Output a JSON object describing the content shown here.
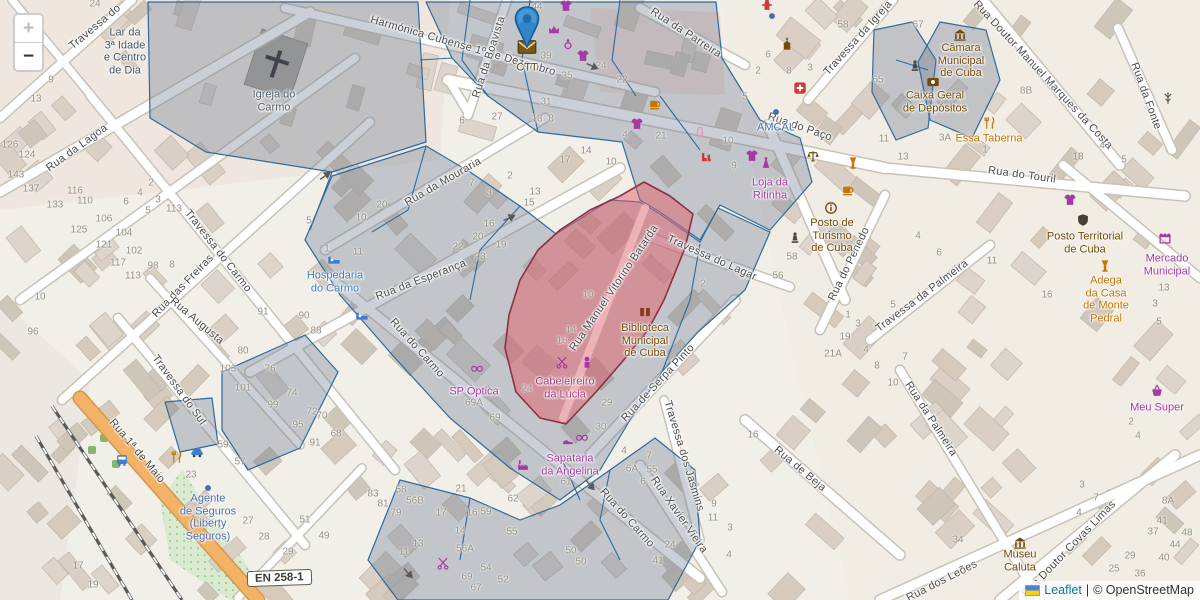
{
  "map": {
    "controls": {
      "zoom_in": "+",
      "zoom_out": "−"
    },
    "attribution": {
      "leaflet": "Leaflet",
      "separator": "|",
      "osm": "© OpenStreetMap"
    },
    "road_shield": "EN 258-1",
    "marker": {
      "poi": "CTT"
    },
    "colors": {
      "shop": "#a539a5",
      "food": "#c77400",
      "civic": "#734a08",
      "tourism": "#3d7cc9",
      "office": "#4a6cae",
      "health": "#cc3b3b",
      "worship": "#51606b",
      "social": "#445668",
      "hair_in_zone": "#ad3a78",
      "street": "#4c4c4c",
      "marker_blue": "#2f86cb",
      "overlay_blue_stroke": "#2f6a9e",
      "red_zone_fill": "#e05f6b",
      "red_zone_stroke": "#8f2f45"
    },
    "street_labels": [
      {
        "t": "Travessa do",
        "x": 95,
        "y": 27,
        "r": -40
      },
      {
        "t": "Harmónica Cubense 1º de Dezembro",
        "x": 463,
        "y": 46,
        "r": 16
      },
      {
        "t": "Rua da Boavista",
        "x": 489,
        "y": 57,
        "r": -72
      },
      {
        "t": "Rua da Parreira",
        "x": 686,
        "y": 33,
        "r": 33
      },
      {
        "t": "Travessa da Igreja",
        "x": 858,
        "y": 38,
        "r": -48
      },
      {
        "t": "Rua Doutor Manuel Marques da Costa",
        "x": 1043,
        "y": 75,
        "r": 47
      },
      {
        "t": "Rua da Fonte",
        "x": 1146,
        "y": 96,
        "r": 70
      },
      {
        "t": "Rua do Paço",
        "x": 800,
        "y": 127,
        "r": 19
      },
      {
        "t": "Rua do Touril",
        "x": 1022,
        "y": 175,
        "r": 8
      },
      {
        "t": "Rua da Mouraria",
        "x": 443,
        "y": 182,
        "r": -30
      },
      {
        "t": "Rua da Lagoa",
        "x": 77,
        "y": 148,
        "r": -36
      },
      {
        "t": "Travessa do Carmo",
        "x": 218,
        "y": 251,
        "r": 52
      },
      {
        "t": "Rua das Freiras",
        "x": 183,
        "y": 286,
        "r": -46
      },
      {
        "t": "Rua Augusta",
        "x": 197,
        "y": 321,
        "r": 40
      },
      {
        "t": "Rua da Esperança",
        "x": 421,
        "y": 280,
        "r": -21
      },
      {
        "t": "Travessa do Sul",
        "x": 179,
        "y": 390,
        "r": 54
      },
      {
        "t": "Rua 1ª de Maio",
        "x": 137,
        "y": 451,
        "r": 50
      },
      {
        "t": "Rua do Carmo",
        "x": 417,
        "y": 348,
        "r": 48
      },
      {
        "t": "Rua do Carmo",
        "x": 627,
        "y": 518,
        "r": 48
      },
      {
        "t": "Rua Manuel Vitorino Batarda",
        "x": 614,
        "y": 288,
        "r": -56
      },
      {
        "t": "Travessa do Lagar",
        "x": 712,
        "y": 258,
        "r": 24
      },
      {
        "t": "Rua de Serpa Pinto",
        "x": 658,
        "y": 383,
        "r": -47
      },
      {
        "t": "Travessa dos Jasmins",
        "x": 684,
        "y": 456,
        "r": 73
      },
      {
        "t": "Rua Xavier Vieira",
        "x": 679,
        "y": 515,
        "r": 55
      },
      {
        "t": "Rua do Penedo",
        "x": 849,
        "y": 264,
        "r": -64
      },
      {
        "t": "Travessa da Palmeira",
        "x": 922,
        "y": 296,
        "r": -37
      },
      {
        "t": "Rua da Palmeira",
        "x": 931,
        "y": 419,
        "r": 57
      },
      {
        "t": "Rua de Beja",
        "x": 800,
        "y": 469,
        "r": 40
      },
      {
        "t": "Rua Doutor Covas Limas",
        "x": 1069,
        "y": 549,
        "r": -46
      },
      {
        "t": "Rua dos Leões",
        "x": 942,
        "y": 581,
        "r": -27
      }
    ],
    "poi_labels": [
      {
        "t": "Igreja do\nCarmo",
        "x": 274,
        "y": 101,
        "c": "worship"
      },
      {
        "t": "Lar da\n3ª Idade\ne Centro\nde Dia",
        "x": 125,
        "y": 52,
        "c": "social"
      },
      {
        "t": "CTT",
        "x": 527,
        "y": 68,
        "c": "civic"
      },
      {
        "t": "Hospedaria\ndo Carmo",
        "x": 335,
        "y": 282,
        "c": "tourism"
      },
      {
        "t": "AMCAL",
        "x": 776,
        "y": 128,
        "c": "office"
      },
      {
        "t": "Loja da\nRitinha",
        "x": 770,
        "y": 189,
        "c": "shop"
      },
      {
        "t": "Posto de\nTurismo\nde Cuba",
        "x": 832,
        "y": 236,
        "c": "civic"
      },
      {
        "t": "Câmara\nMunicipal\nde Cuba",
        "x": 961,
        "y": 61,
        "c": "civic"
      },
      {
        "t": "Caixa Geral\nde Depósitos",
        "x": 935,
        "y": 102,
        "c": "civic"
      },
      {
        "t": "Essa Taberna",
        "x": 989,
        "y": 139,
        "c": "food"
      },
      {
        "t": "Posto Territorial\nde Cuba",
        "x": 1085,
        "y": 243,
        "c": "civic"
      },
      {
        "t": "Mercado\nMunicipal",
        "x": 1167,
        "y": 265,
        "c": "shop"
      },
      {
        "t": "Adega\nda Casa\nde Monte\nPedral",
        "x": 1106,
        "y": 300,
        "c": "food"
      },
      {
        "t": "Biblioteca\nMunicipal\nde Cuba",
        "x": 645,
        "y": 341,
        "c": "civic"
      },
      {
        "t": "SP Óptica",
        "x": 474,
        "y": 392,
        "c": "shop"
      },
      {
        "t": "Cabeleireiro\nda Lúcia",
        "x": 565,
        "y": 388,
        "c": "hair_in_zone"
      },
      {
        "t": "Sapataria\nda Angelina",
        "x": 570,
        "y": 465,
        "c": "shop"
      },
      {
        "t": "Agente\nde Seguros\n(Liberty\nSeguros)",
        "x": 208,
        "y": 518,
        "c": "office"
      },
      {
        "t": "Meu Super",
        "x": 1157,
        "y": 408,
        "c": "shop"
      },
      {
        "t": "Museu\nCaluta",
        "x": 1020,
        "y": 561,
        "c": "civic"
      }
    ],
    "icons": [
      [
        "envelope",
        527,
        47
      ],
      [
        "tshirt",
        566,
        6
      ],
      [
        "crown",
        554,
        30
      ],
      [
        "ring",
        568,
        44
      ],
      [
        "tshirt",
        583,
        56
      ],
      [
        "cup",
        655,
        104
      ],
      [
        "tshirt",
        637,
        124
      ],
      [
        "clip",
        700,
        132
      ],
      [
        "boots",
        706,
        158
      ],
      [
        "tshirt",
        752,
        156
      ],
      [
        "dress",
        766,
        163
      ],
      [
        "scales",
        813,
        156
      ],
      [
        "pharmacy",
        800,
        88
      ],
      [
        "hydrant",
        767,
        5
      ],
      [
        "chapel",
        787,
        44
      ],
      [
        "dot",
        772,
        16
      ],
      [
        "dot",
        776,
        112
      ],
      [
        "statue",
        915,
        66
      ],
      [
        "cup",
        848,
        190
      ],
      [
        "goblet",
        853,
        163
      ],
      [
        "statue",
        795,
        238
      ],
      [
        "mast",
        1168,
        98
      ],
      [
        "info",
        831,
        208
      ],
      [
        "townhall",
        960,
        35
      ],
      [
        "bank",
        933,
        82
      ],
      [
        "cutlery",
        990,
        123
      ],
      [
        "police",
        1083,
        220
      ],
      [
        "tshirt",
        1070,
        200
      ],
      [
        "market",
        1165,
        238
      ],
      [
        "wine",
        1105,
        266
      ],
      [
        "basket",
        1157,
        391
      ],
      [
        "museum",
        1020,
        543
      ],
      [
        "bed",
        334,
        260
      ],
      [
        "bed",
        362,
        316
      ],
      [
        "book",
        645,
        312
      ],
      [
        "glasses",
        477,
        368
      ],
      [
        "scissors",
        562,
        362
      ],
      [
        "cosmetics",
        587,
        362
      ],
      [
        "shoe",
        568,
        440
      ],
      [
        "glasses",
        582,
        437
      ],
      [
        "factory",
        523,
        465
      ],
      [
        "scissors",
        443,
        563
      ],
      [
        "bus",
        122,
        460
      ],
      [
        "car",
        197,
        452
      ],
      [
        "cutlery",
        177,
        457
      ],
      [
        "dot",
        208,
        488
      ]
    ],
    "house_numbers": [
      [
        "24",
        95,
        4
      ],
      [
        "9",
        51,
        80
      ],
      [
        "13",
        36,
        99
      ],
      [
        "126",
        10,
        145
      ],
      [
        "124",
        27,
        155
      ],
      [
        "143",
        16,
        175
      ],
      [
        "137",
        31,
        189
      ],
      [
        "133",
        55,
        205
      ],
      [
        "116",
        75,
        191
      ],
      [
        "110",
        85,
        201
      ],
      [
        "106",
        104,
        219
      ],
      [
        "104",
        124,
        233
      ],
      [
        "102",
        134,
        251
      ],
      [
        "125",
        79,
        230
      ],
      [
        "121",
        104,
        245
      ],
      [
        "117",
        118,
        263
      ],
      [
        "113",
        133,
        276
      ],
      [
        "98",
        153,
        266
      ],
      [
        "8",
        172,
        265
      ],
      [
        "5",
        148,
        211
      ],
      [
        "6",
        126,
        202
      ],
      [
        "4",
        140,
        193
      ],
      [
        "3",
        158,
        200
      ],
      [
        "113",
        174,
        209
      ],
      [
        "2",
        151,
        183
      ],
      [
        "96",
        33,
        332
      ],
      [
        "10",
        40,
        297
      ],
      [
        "91",
        263,
        312
      ],
      [
        "90",
        304,
        316
      ],
      [
        "88",
        316,
        331
      ],
      [
        "80",
        243,
        351
      ],
      [
        "76",
        270,
        369
      ],
      [
        "103",
        228,
        369
      ],
      [
        "101",
        243,
        388
      ],
      [
        "74",
        292,
        393
      ],
      [
        "99",
        273,
        405
      ],
      [
        "72",
        312,
        412
      ],
      [
        "70",
        322,
        416
      ],
      [
        "95",
        298,
        425
      ],
      [
        "68",
        336,
        434
      ],
      [
        "17",
        78,
        566
      ],
      [
        "19",
        93,
        585
      ],
      [
        "59",
        223,
        445
      ],
      [
        "57",
        240,
        462
      ],
      [
        "23",
        191,
        475
      ],
      [
        "91",
        315,
        443
      ],
      [
        "27",
        248,
        521
      ],
      [
        "28",
        264,
        537
      ],
      [
        "29",
        288,
        552
      ],
      [
        "51",
        305,
        520
      ],
      [
        "49",
        324,
        536
      ],
      [
        "44",
        537,
        7
      ],
      [
        "39",
        546,
        56
      ],
      [
        "35",
        567,
        76
      ],
      [
        "24",
        601,
        66
      ],
      [
        "22",
        622,
        80
      ],
      [
        "27",
        497,
        117
      ],
      [
        "18",
        537,
        119
      ],
      [
        "8",
        551,
        119
      ],
      [
        "6",
        462,
        121
      ],
      [
        "31",
        546,
        102
      ],
      [
        "20",
        382,
        205
      ],
      [
        "10",
        361,
        218
      ],
      [
        "5",
        309,
        221
      ],
      [
        "11",
        358,
        252
      ],
      [
        "1",
        327,
        249
      ],
      [
        "7",
        472,
        183
      ],
      [
        "2",
        510,
        176
      ],
      [
        "3",
        489,
        193
      ],
      [
        "13",
        535,
        192
      ],
      [
        "15",
        529,
        203
      ],
      [
        "16",
        489,
        224
      ],
      [
        "20",
        478,
        237
      ],
      [
        "22",
        458,
        247
      ],
      [
        "23",
        480,
        257
      ],
      [
        "19",
        501,
        245
      ],
      [
        "17",
        565,
        160
      ],
      [
        "4",
        625,
        135
      ],
      [
        "21",
        661,
        136
      ],
      [
        "14",
        586,
        151
      ],
      [
        "10",
        611,
        162
      ],
      [
        "58",
        843,
        25
      ],
      [
        "67",
        918,
        25
      ],
      [
        "65",
        878,
        80
      ],
      [
        "6",
        768,
        55
      ],
      [
        "8",
        789,
        71
      ],
      [
        "3",
        810,
        68
      ],
      [
        "5",
        745,
        97
      ],
      [
        "2",
        758,
        71
      ],
      [
        "10",
        728,
        141
      ],
      [
        "9",
        734,
        166
      ],
      [
        "11",
        884,
        139
      ],
      [
        "3A",
        945,
        138
      ],
      [
        "13",
        903,
        157
      ],
      [
        "8B",
        1026,
        91
      ],
      [
        "18",
        1078,
        157
      ],
      [
        "4",
        1102,
        146
      ],
      [
        "5",
        1124,
        160
      ],
      [
        "1",
        985,
        150
      ],
      [
        "58",
        792,
        257
      ],
      [
        "56",
        778,
        276
      ],
      [
        "2",
        703,
        284
      ],
      [
        "10",
        588,
        295
      ],
      [
        "14",
        571,
        330
      ],
      [
        "16",
        562,
        341
      ],
      [
        "24",
        527,
        389
      ],
      [
        "29",
        607,
        403
      ],
      [
        "69A",
        474,
        403
      ],
      [
        "69",
        495,
        418
      ],
      [
        "4",
        918,
        236
      ],
      [
        "6",
        939,
        253
      ],
      [
        "11",
        992,
        261
      ],
      [
        "5",
        893,
        305
      ],
      [
        "1",
        848,
        315
      ],
      [
        "3",
        858,
        324
      ],
      [
        "19",
        845,
        337
      ],
      [
        "4",
        866,
        350
      ],
      [
        "8",
        877,
        366
      ],
      [
        "10",
        893,
        383
      ],
      [
        "7",
        905,
        357
      ],
      [
        "21A",
        833,
        354
      ],
      [
        "16",
        1047,
        295
      ],
      [
        "13",
        1164,
        288
      ],
      [
        "3",
        1155,
        304
      ],
      [
        "5",
        1159,
        322
      ],
      [
        "2",
        1131,
        422
      ],
      [
        "4",
        1138,
        436
      ],
      [
        "3",
        1082,
        485
      ],
      [
        "7",
        1096,
        498
      ],
      [
        "4",
        1079,
        513
      ],
      [
        "8A",
        1168,
        501
      ],
      [
        "41",
        1162,
        521
      ],
      [
        "37",
        1153,
        532
      ],
      [
        "48",
        1187,
        533
      ],
      [
        "44",
        1175,
        545
      ],
      [
        "29",
        1130,
        556
      ],
      [
        "40",
        1164,
        558
      ],
      [
        "25",
        1114,
        569
      ],
      [
        "36",
        1140,
        574
      ],
      [
        "34",
        958,
        540
      ],
      [
        "30",
        601,
        427
      ],
      [
        "4",
        624,
        451
      ],
      [
        "7",
        649,
        456
      ],
      [
        "6A",
        632,
        469
      ],
      [
        "6",
        643,
        482
      ],
      [
        "61",
        566,
        482
      ],
      [
        "62",
        513,
        499
      ],
      [
        "55",
        652,
        470
      ],
      [
        "55",
        512,
        532
      ],
      [
        "24",
        670,
        545
      ],
      [
        "41",
        658,
        561
      ],
      [
        "16",
        753,
        435
      ],
      [
        "9",
        714,
        504
      ],
      [
        "11",
        713,
        518
      ],
      [
        "3",
        730,
        528
      ],
      [
        "4",
        729,
        555
      ],
      [
        "83",
        373,
        494
      ],
      [
        "81",
        383,
        504
      ],
      [
        "79",
        396,
        513
      ],
      [
        "58",
        401,
        490
      ],
      [
        "56B",
        415,
        501
      ],
      [
        "17",
        441,
        513
      ],
      [
        "21",
        461,
        489
      ],
      [
        "16",
        472,
        513
      ],
      [
        "59",
        486,
        512
      ],
      [
        "14",
        460,
        531
      ],
      [
        "13",
        418,
        544
      ],
      [
        "11",
        404,
        552
      ],
      [
        "56A",
        465,
        549
      ],
      [
        "54",
        486,
        568
      ],
      [
        "69",
        467,
        577
      ],
      [
        "67",
        476,
        588
      ],
      [
        "52",
        503,
        580
      ],
      [
        "50",
        571,
        551
      ],
      [
        "50",
        581,
        562
      ]
    ],
    "oneway_arrows": [
      [
        592,
        66,
        25
      ],
      [
        325,
        176,
        -35
      ],
      [
        509,
        218,
        -25
      ],
      [
        590,
        485,
        48
      ],
      [
        408,
        573,
        48
      ]
    ]
  }
}
